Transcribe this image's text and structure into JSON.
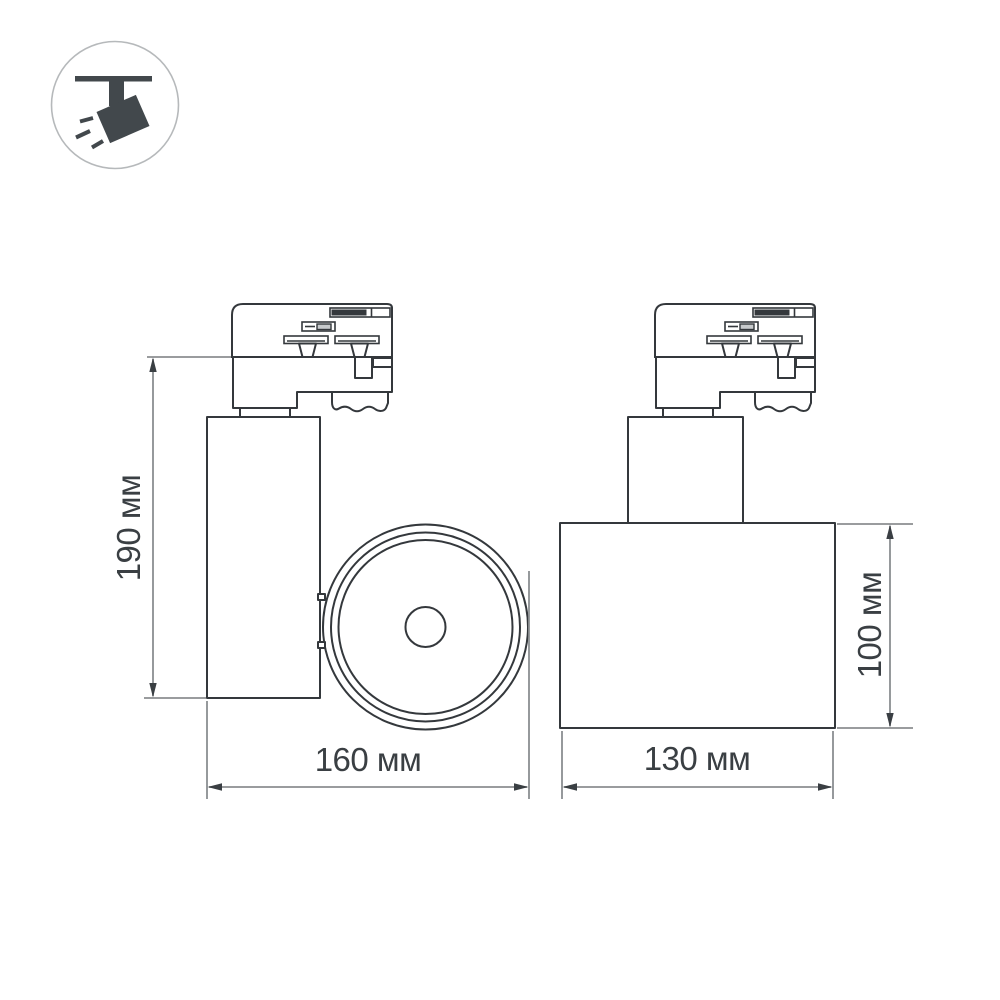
{
  "icon": {
    "name": "ceiling-track-spotlight-pictogram",
    "parts": [
      "ceiling-bar",
      "mount-stem",
      "lamp-head",
      "light-rays"
    ]
  },
  "views": {
    "side_view": "track spotlight side view with track adapter, cylindrical housing and front lens circle",
    "front_view": "track spotlight rotated view with track adapter, neck cylinder and wide body"
  },
  "dimensions": {
    "height_side": "190 мм",
    "width_side": "160 мм",
    "width_front": "130 мм",
    "height_front": "100 мм"
  },
  "colors": {
    "background": "#ffffff",
    "drawing_outline": "#34383c",
    "dimension_line": "#8b8e91",
    "dimension_text": "#3a3f43",
    "icon_fill": "#42484c",
    "icon_ring": "#b6b9bb"
  }
}
